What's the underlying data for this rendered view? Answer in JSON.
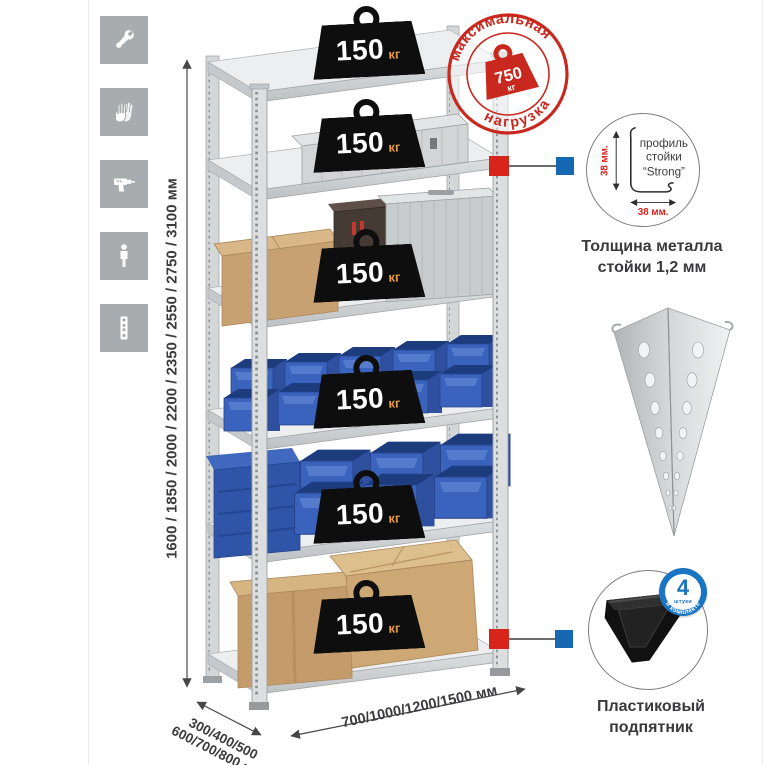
{
  "sidebar": {
    "icons": [
      {
        "name": "wrench"
      },
      {
        "name": "gloves"
      },
      {
        "name": "drill"
      },
      {
        "name": "person"
      },
      {
        "name": "rack-post"
      }
    ]
  },
  "dimensions": {
    "height": "1600 / 1850 / 2000 / 2200 / 2350 / 2550 / 2750 / 3100 мм",
    "depth_line1": "300/400/500",
    "depth_line2": "600/700/800 мм",
    "width": "700/1000/1200/1500 мм"
  },
  "shelf_load": {
    "value": "150",
    "unit": "кг"
  },
  "max_load": {
    "arc_top": "максимальная",
    "arc_bottom": "нагрузка",
    "value": "750",
    "unit": "кг"
  },
  "profile": {
    "label_line1": "профиль",
    "label_line2": "стойки",
    "label_line3": "“Strong”",
    "dim_vertical": "38 мм.",
    "dim_horizontal": "38 мм.",
    "caption_line1": "Толщина металла",
    "caption_line2": "стойки 1,2 мм"
  },
  "foot": {
    "badge_number": "4",
    "badge_small": "штуки",
    "badge_arc": "в комплекте",
    "caption_line1": "Пластиковый",
    "caption_line2": "подпятник"
  },
  "colors": {
    "stamp_red": "#c8281e",
    "callout_red": "#d8251c",
    "callout_blue": "#1668b2",
    "bin_blue": "#3a63bd",
    "unit_orange": "#e89a3e",
    "icon_gray": "#a8acae"
  }
}
